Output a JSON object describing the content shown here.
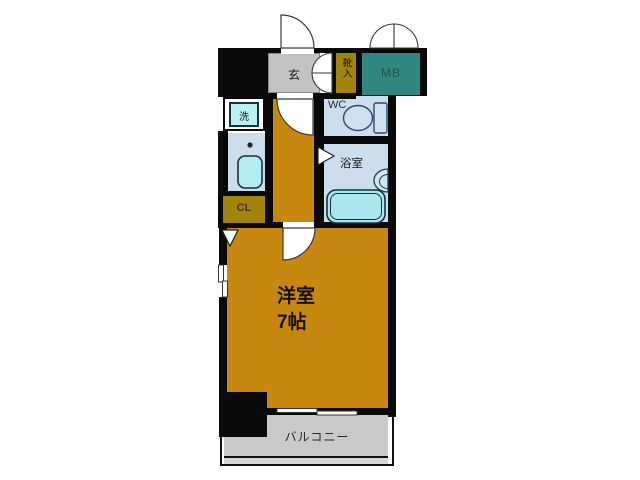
{
  "plan": {
    "type": "apartment-floor-plan",
    "rooms": {
      "genkan": {
        "label": "玄"
      },
      "shoe_box": {
        "label": "靴入"
      },
      "meter_box": {
        "label": "MB"
      },
      "washer": {
        "label": "洗"
      },
      "wc": {
        "label": "WC"
      },
      "bathroom": {
        "label": "浴室"
      },
      "closet": {
        "label": "CL"
      },
      "main_room": {
        "label": "洋室",
        "size": "7帖"
      },
      "balcony": {
        "label": "バルコニー"
      }
    },
    "fixtures": [
      "toilet",
      "bathtub",
      "washbasin",
      "kitchen-sink",
      "stove-burner",
      "washing-machine"
    ],
    "colors": {
      "wall": "#0a0a0a",
      "room_orange": "#c8870f",
      "genkan_gray": "#c3c3c3",
      "storage_olive": "#a2830b",
      "meter_box_teal": "#308680",
      "wet_area_blue": "#ccddee",
      "fixture_cyan": "#b4ecf4",
      "balcony_gray": "#c9c9c9",
      "background": "#ffffff"
    }
  }
}
